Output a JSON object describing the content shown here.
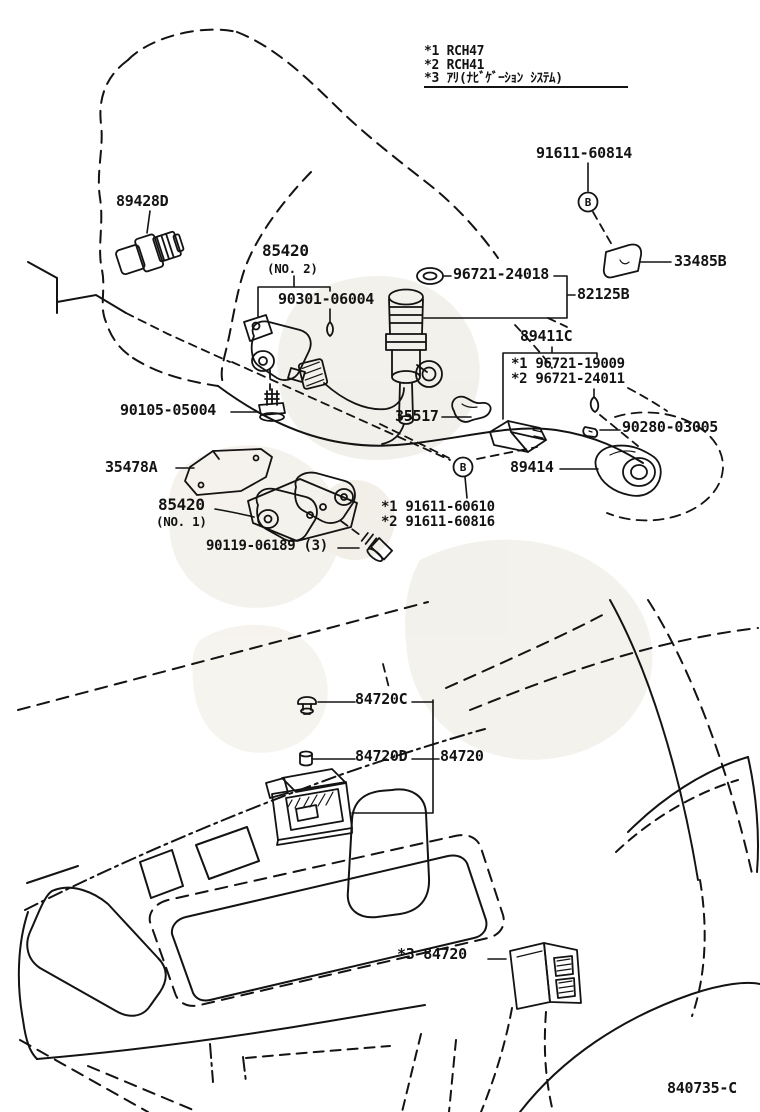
{
  "page": {
    "background": "#ffffff",
    "line_color": "#131313",
    "watermark_color": "#e9e5da"
  },
  "legend": {
    "items": [
      "*1 RCH47",
      "*2 RCH41",
      "*3 ｱﾘ(ﾅﾋﾞｹﾞｰｼｮﾝ ｼｽﾃﾑ)"
    ]
  },
  "marks": {
    "b": "B"
  },
  "labels": {
    "p91611_60814": "91611-60814",
    "p33485b": "33485B",
    "p89428d": "89428D",
    "p85420_2": "85420",
    "p85420_2_note": "(NO. 2)",
    "p90301_06004": "90301-06004",
    "p96721_24018": "96721-24018",
    "p82125b": "82125B",
    "p89411c": "89411C",
    "p96721_19009": "*1 96721-19009",
    "p96721_24011": "*2 96721-24011",
    "p90280_03005": "90280-03005",
    "p90105_05004": "90105-05004",
    "p35517": "35517",
    "p35478a": "35478A",
    "p89414": "89414",
    "p85420_1": "85420",
    "p85420_1_note": "(NO. 1)",
    "p91611_60610": "*1 91611-60610",
    "p91611_60816": "*2 91611-60816",
    "p90119_06189": "90119-06189 (3)",
    "p84720c": "84720C",
    "p84720d": "84720D",
    "p84720": "84720",
    "p84720_nav": "*3 84720",
    "code": "840735-C"
  }
}
